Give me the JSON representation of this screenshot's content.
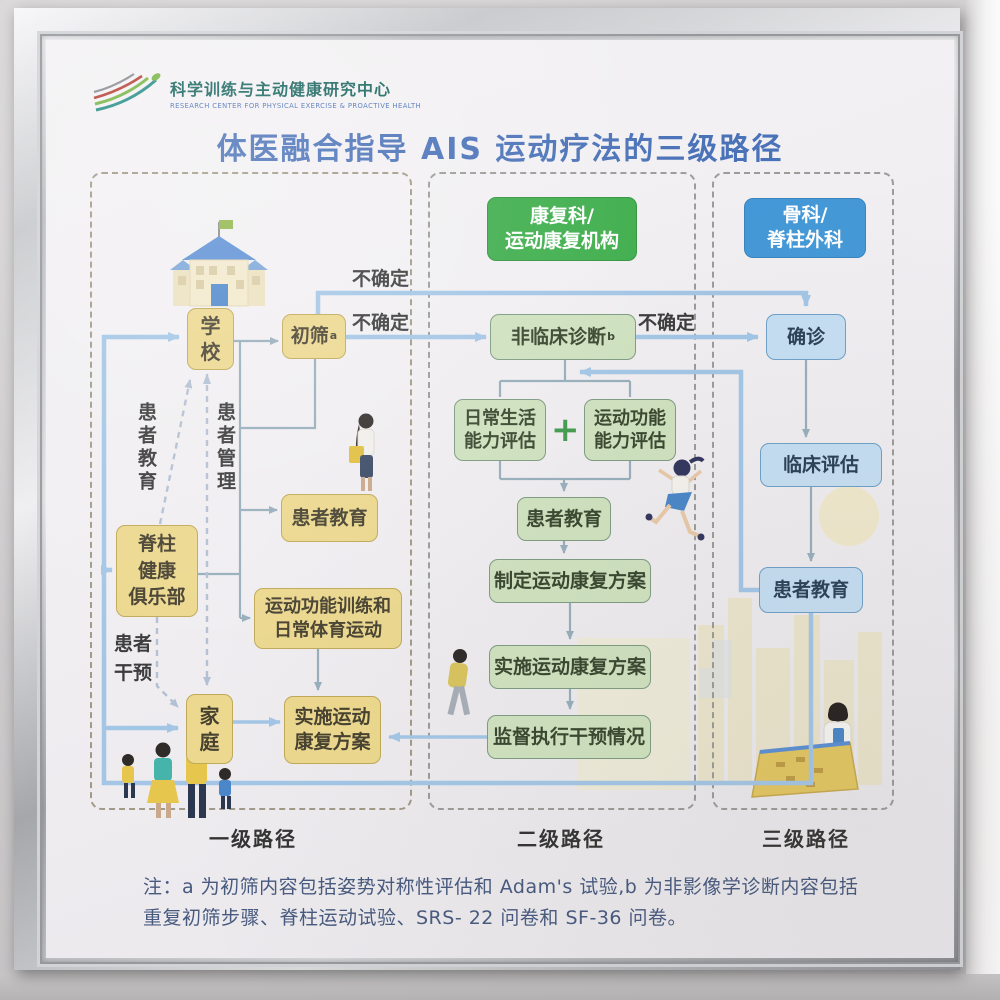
{
  "logo": {
    "name_zh": "科学训练与主动健康研究中心",
    "name_en": "RESEARCH CENTER FOR PHYSICAL EXERCISE & PROACTIVE HEALTH"
  },
  "title": "体医融合指导 AIS 运动疗法的三级路径",
  "headers": {
    "rehab": "康复科/\n运动康复机构",
    "ortho": "骨科/\n脊柱外科"
  },
  "nodes": {
    "school": "学\n校",
    "screening": "初筛",
    "screening_sup": "a",
    "patient_edu_l1": "患者教育",
    "spine_club": "脊柱\n健康\n俱乐部",
    "training": "运动功能训练和\n日常体育运动",
    "family": "家\n庭",
    "implement_l1": "实施运动\n康复方案",
    "nonclinical_dx": "非临床诊断",
    "nonclinical_sup": "b",
    "adl_assess": "日常生活\n能力评估",
    "plus": "+",
    "motor_assess": "运动功能\n能力评估",
    "patient_edu_l2": "患者教育",
    "make_plan": "制定运动康复方案",
    "implement_l2": "实施运动康复方案",
    "supervise": "监督执行干预情况",
    "confirm_dx": "确诊",
    "clinical_eval": "临床评估",
    "patient_edu_l3": "患者教育"
  },
  "edge_labels": {
    "uncertain_top": "不确定",
    "uncertain_mid": "不确定",
    "uncertain_right": "不确定",
    "patient_edu": "患者教育",
    "patient_mgmt": "患者管理",
    "patient_intervention": "患者\n干预"
  },
  "footer": {
    "path1": "一级路径",
    "path2": "二级路径",
    "path3": "三级路径"
  },
  "note": "注：a 为初筛内容包括姿势对称性评估和 Adam's 试验,b 为非影像学诊断内容包括\n重复初筛步骤、脊柱运动试验、SRS- 22 问卷和 SF-36 问卷。",
  "colors": {
    "title": "#4a72b8",
    "level1_box": "#ecd88e",
    "level2_box": "#cfe2bf",
    "level3_box": "#c5def2",
    "header_green": "#3fae4d",
    "header_blue": "#4598d7",
    "arrow_blue": "#a3c6e6"
  }
}
